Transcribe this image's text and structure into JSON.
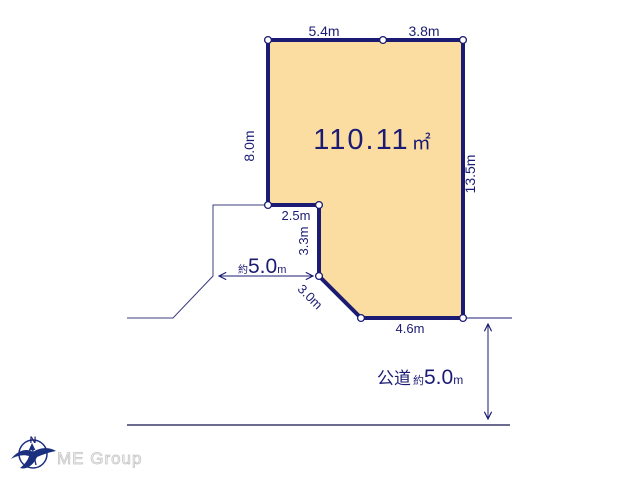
{
  "diagram": {
    "area": {
      "value": "110.11",
      "unit": "㎡"
    },
    "edges": {
      "top_left": "5.4m",
      "top_right": "3.8m",
      "left": "8.0m",
      "right": "13.5m",
      "notch_top": "2.5m",
      "notch_side": "3.3m",
      "notch_diagonal": "3.0m",
      "bottom": "4.6m"
    },
    "west_road": {
      "approx": "約",
      "value": "5.0",
      "unit": "m"
    },
    "south_road": {
      "name": "公道",
      "approx": "約",
      "value": "5.0",
      "unit": "m"
    },
    "colors": {
      "plot_fill": "#FBDDA2",
      "line_navy": "#1B1B73",
      "road_line": "#6C6C91",
      "logo_gray": "#C6C6C6"
    }
  },
  "logo": {
    "company": "ME Group",
    "compass_north": "N"
  }
}
